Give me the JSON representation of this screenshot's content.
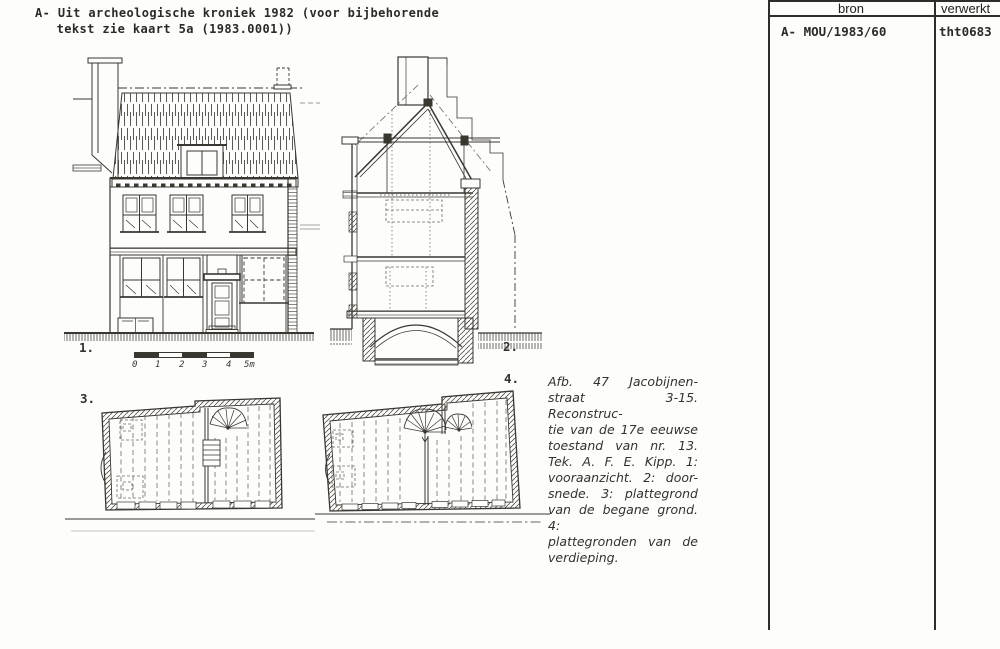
{
  "header": {
    "line1": "A- Uit archeologische kroniek 1982 (voor bijbehorende",
    "line2": "tekst zie kaart 5a (1983.0001))"
  },
  "figures": {
    "elevation_label": "1.",
    "section_label": "2.",
    "ground_plan_label": "3.",
    "upper_plan_label": "4."
  },
  "scale_bar": {
    "labels": [
      "0",
      "1",
      "2",
      "3",
      "4",
      "5m"
    ]
  },
  "caption": {
    "lines": [
      "Afb. 47  Jacobijnen-",
      "straat 3-15. Reconstruc-",
      "tie van de 17e eeuwse",
      "toestand van nr. 13.",
      "Tek. A. F. E. Kipp. 1:",
      "vooraanzicht. 2: door-",
      "snede. 3: plattegrond",
      "van de begane grond. 4:",
      "plattegronden van de",
      "verdieping."
    ]
  },
  "register": {
    "bron_header": "bron",
    "verwerkt_header": "verwerkt",
    "bron_value": "A- MOU/1983/60",
    "verwerkt_value": "tht0683"
  },
  "colors": {
    "ink": "#34312b",
    "paper": "#fdfdfc"
  }
}
